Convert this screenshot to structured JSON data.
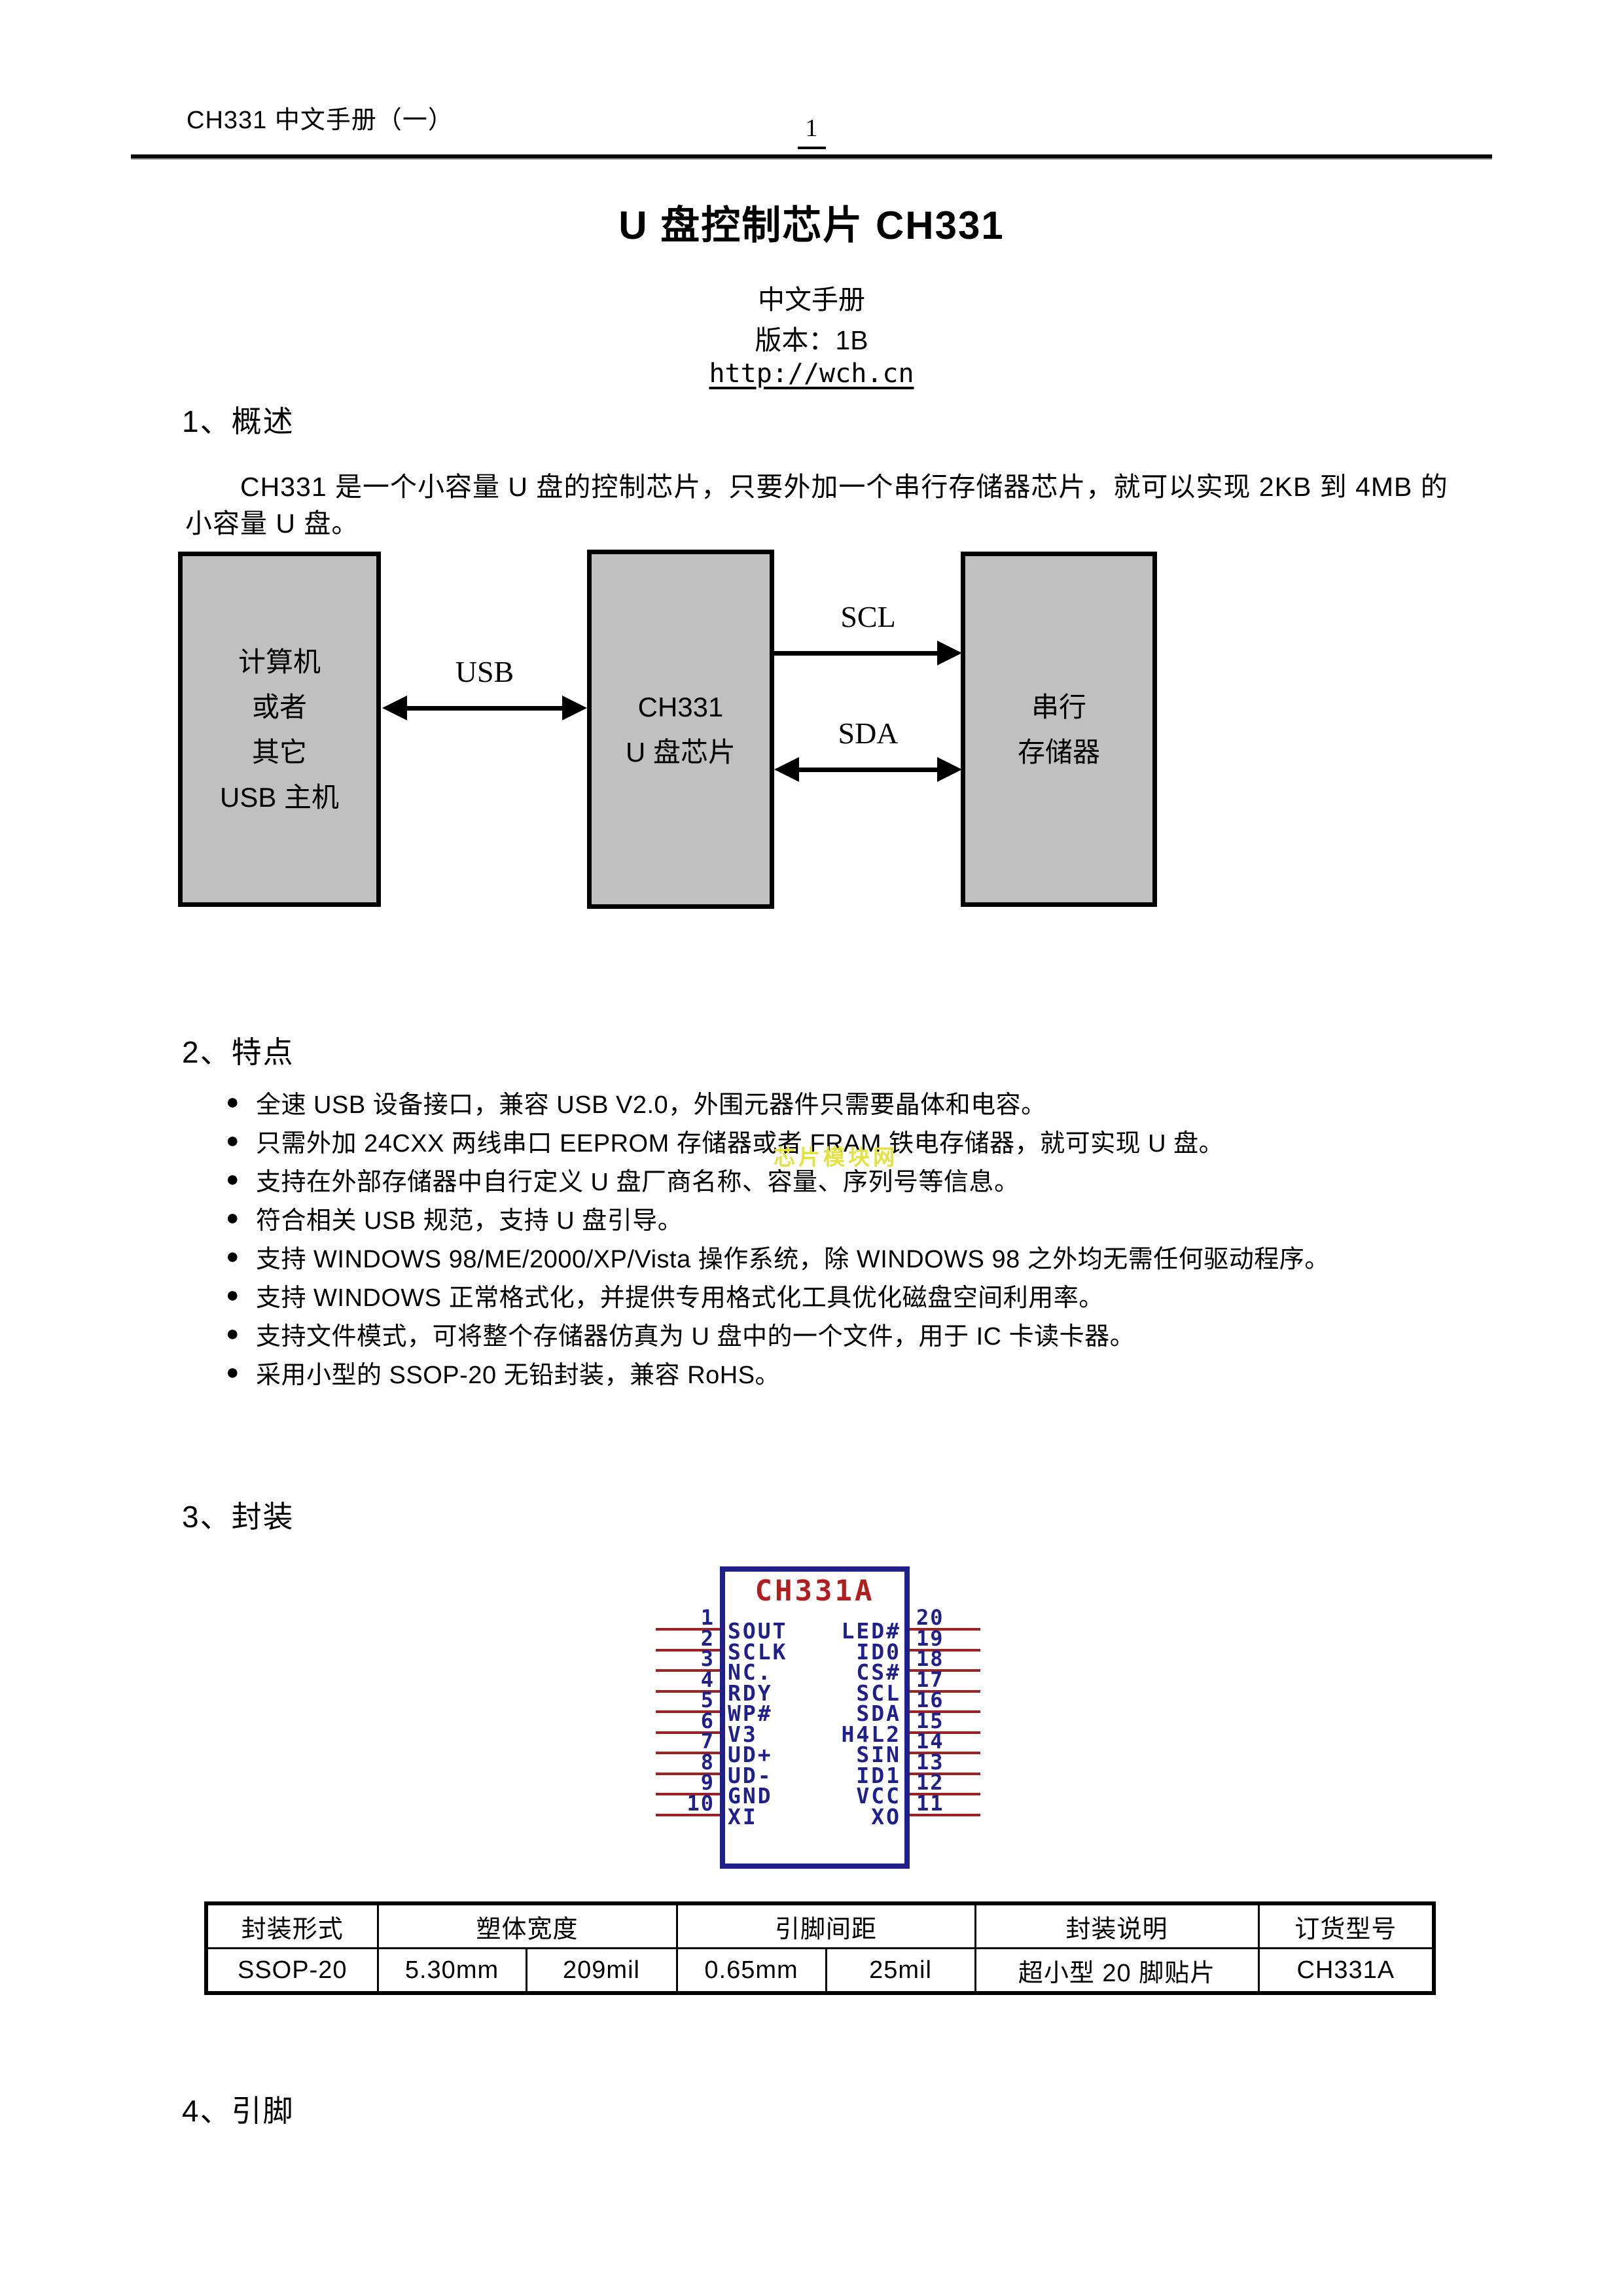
{
  "header": {
    "doc_title": "CH331 中文手册（一）",
    "page_number": "1"
  },
  "title_block": {
    "title": "U 盘控制芯片 CH331",
    "subtitle": "中文手册",
    "version": "版本：1B",
    "url": "http://wch.cn"
  },
  "overview": {
    "heading": "1、概述",
    "line1": "CH331 是一个小容量 U 盘的控制芯片，只要外加一个串行存储器芯片，就可以实现 2KB 到 4MB 的",
    "line2": "小容量 U 盘。"
  },
  "diagram": {
    "host_box": {
      "line1": "计算机",
      "line2": "或者",
      "line3": "其它",
      "line4": "USB 主机"
    },
    "chip_box": {
      "line1": "CH331",
      "line2": "U 盘芯片"
    },
    "mem_box": {
      "line1": "串行",
      "line2": "存储器"
    },
    "usb_label": "USB",
    "scl_label": "SCL",
    "sda_label": "SDA"
  },
  "features": {
    "heading": "2、特点",
    "bullet_glyph": "●",
    "items": [
      "全速 USB 设备接口，兼容 USB V2.0，外围元器件只需要晶体和电容。",
      "只需外加 24CXX 两线串口 EEPROM 存储器或者 FRAM 铁电存储器，就可实现 U 盘。",
      "支持在外部存储器中自行定义 U 盘厂商名称、容量、序列号等信息。",
      "符合相关 USB 规范，支持 U 盘引导。",
      "支持 WINDOWS 98/ME/2000/XP/Vista 操作系统，除 WINDOWS 98 之外均无需任何驱动程序。",
      "支持 WINDOWS 正常格式化，并提供专用格式化工具优化磁盘空间利用率。",
      "支持文件模式，可将整个存储器仿真为 U 盘中的一个文件，用于 IC 卡读卡器。",
      "采用小型的 SSOP-20 无铅封装，兼容 RoHS。"
    ]
  },
  "watermark": "芯片模块网",
  "package": {
    "heading": "3、封装",
    "chip": {
      "name": "CH331A",
      "left_pins": [
        {
          "num": "1",
          "name": "SOUT"
        },
        {
          "num": "2",
          "name": "SCLK"
        },
        {
          "num": "3",
          "name": "NC."
        },
        {
          "num": "4",
          "name": "RDY"
        },
        {
          "num": "5",
          "name": "WP#"
        },
        {
          "num": "6",
          "name": "V3"
        },
        {
          "num": "7",
          "name": "UD+"
        },
        {
          "num": "8",
          "name": "UD-"
        },
        {
          "num": "9",
          "name": "GND"
        },
        {
          "num": "10",
          "name": "XI"
        }
      ],
      "right_pins": [
        {
          "num": "20",
          "name": "LED#"
        },
        {
          "num": "19",
          "name": "ID0"
        },
        {
          "num": "18",
          "name": "CS#"
        },
        {
          "num": "17",
          "name": "SCL"
        },
        {
          "num": "16",
          "name": "SDA"
        },
        {
          "num": "15",
          "name": "H4L2"
        },
        {
          "num": "14",
          "name": "SIN"
        },
        {
          "num": "13",
          "name": "ID1"
        },
        {
          "num": "12",
          "name": "VCC"
        },
        {
          "num": "11",
          "name": "XO"
        }
      ]
    },
    "table": {
      "headers": [
        "封装形式",
        "塑体宽度",
        "引脚间距",
        "封装说明",
        "订货型号"
      ],
      "row": [
        "SSOP-20",
        "5.30mm",
        "209mil",
        "0.65mm",
        "25mil",
        "超小型 20 脚贴片",
        "CH331A"
      ]
    }
  },
  "pins_section": {
    "heading": "4、引脚"
  },
  "colors": {
    "box_fill": "#c0c0c0",
    "chip_border": "#20208c",
    "chip_title_red": "#b21d1d",
    "pin_line_red": "#9b2323",
    "pin_text_blue": "#20208c",
    "watermark_yellow": "#e5e23e"
  }
}
